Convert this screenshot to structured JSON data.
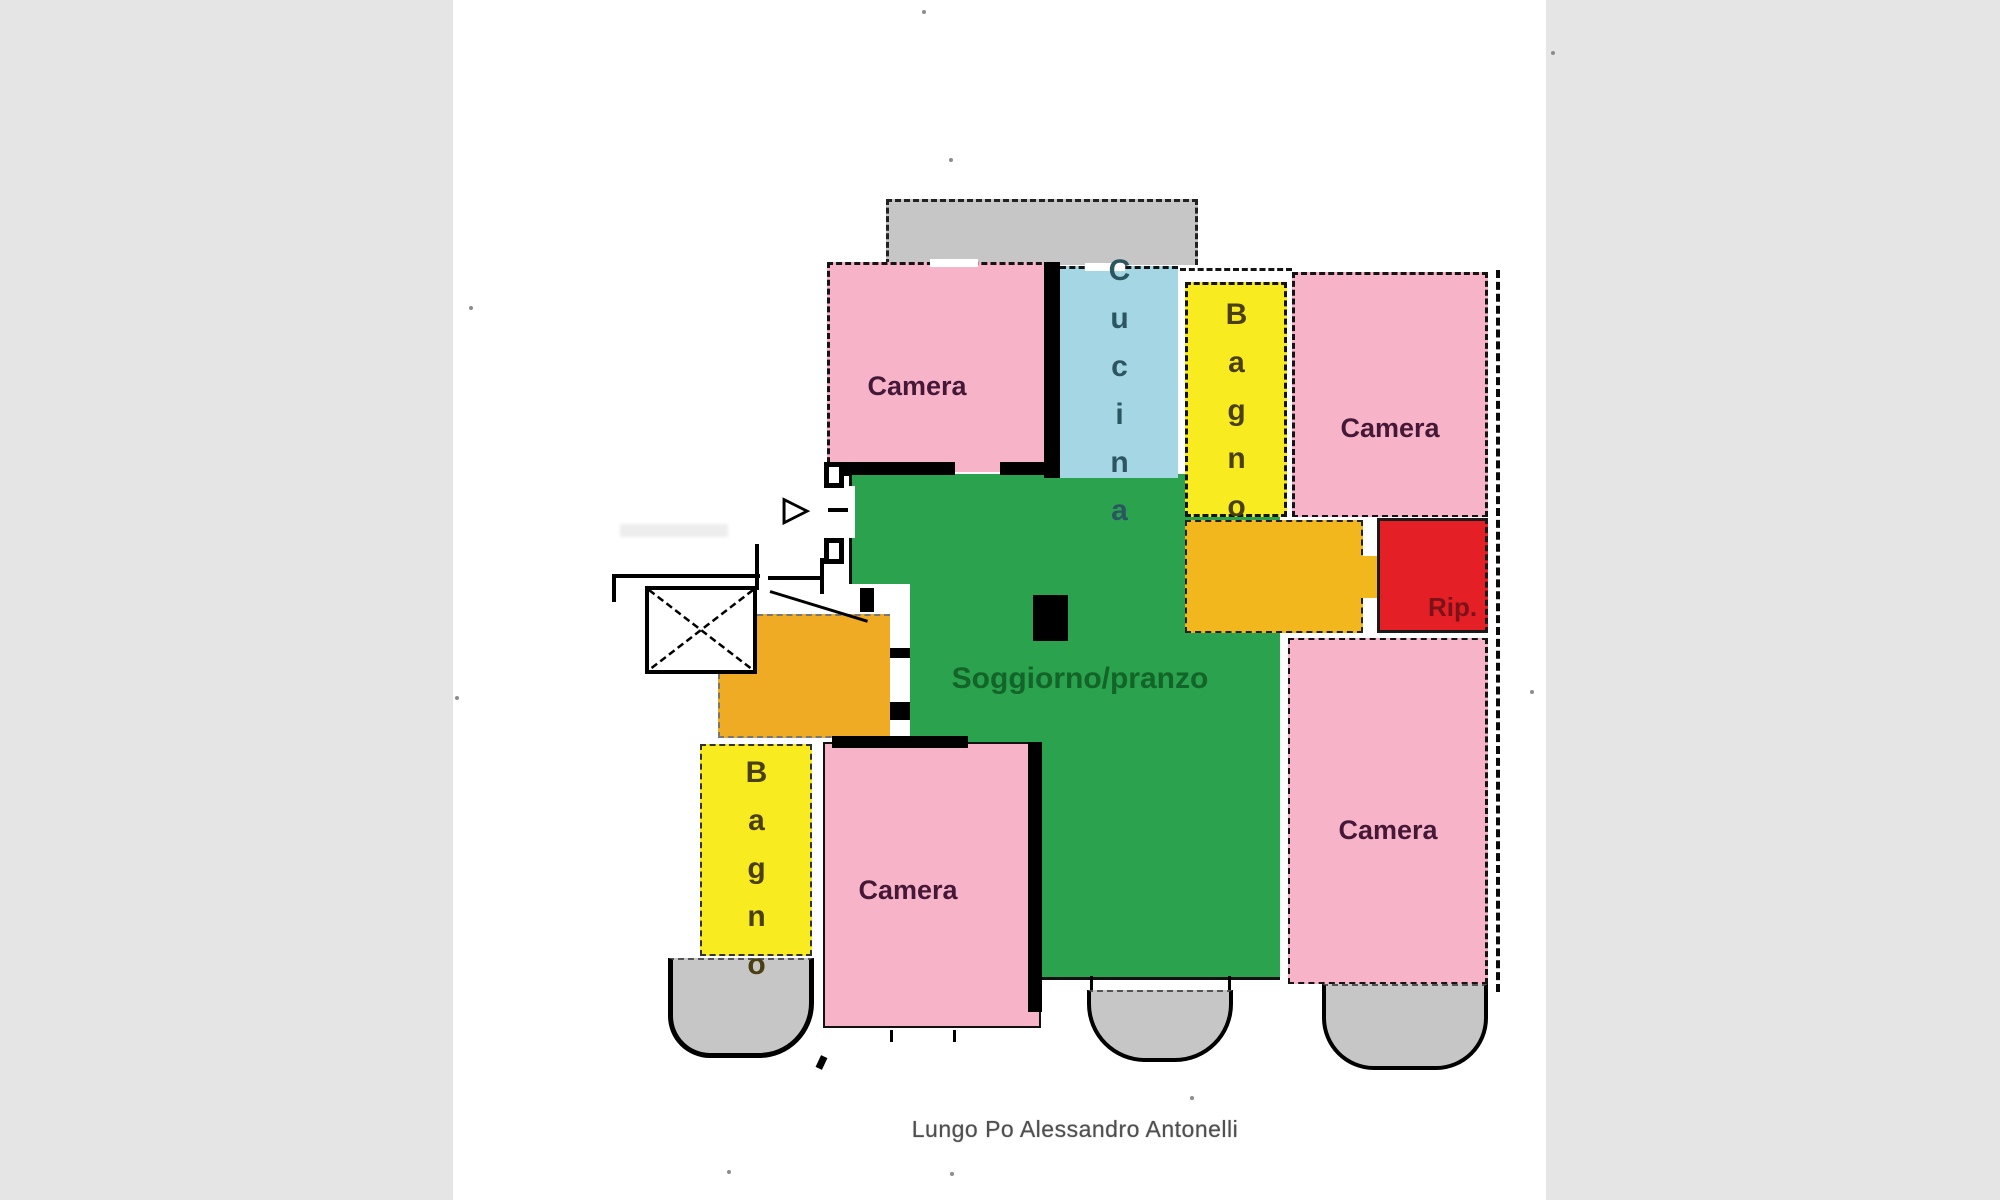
{
  "floorplan": {
    "caption": "Lungo Po Alessandro Antonelli",
    "rooms": {
      "camera_top_left": {
        "label": "Camera"
      },
      "cucina": {
        "label": "Cucina"
      },
      "bagno_top": {
        "label": "Bagno"
      },
      "camera_top_right": {
        "label": "Camera"
      },
      "ripostiglio": {
        "label": "Rip."
      },
      "soggiorno": {
        "label": "Soggiorno/pranzo"
      },
      "bagno_left": {
        "label": "Bagno"
      },
      "camera_bottom_left": {
        "label": "Camera"
      },
      "camera_right": {
        "label": "Camera"
      }
    },
    "icons": {
      "entry_arrow_glyph": "▷"
    },
    "colors": {
      "bedroom_pink": "#f7b3c7",
      "living_green": "#2ba24e",
      "kitchen_blue": "#a5d6e3",
      "bathroom_yellow": "#f8ec20",
      "hallway_orange": "#f3b71e",
      "entry_orange": "#f0ab25",
      "storage_red": "#e51f26",
      "balcony_gray": "#c6c6c6",
      "page_side_gray": "#e5e5e5",
      "wall_black": "#000000",
      "label_maroon": "#451837",
      "label_green": "#136428",
      "label_teal": "#2b5560",
      "label_olive": "#4a3f10",
      "label_dark_red": "#7c1218",
      "caption_gray": "#4f4f4f"
    }
  }
}
